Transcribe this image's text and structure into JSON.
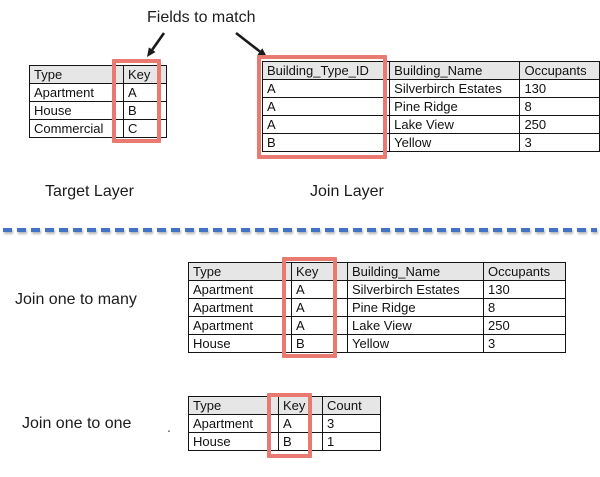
{
  "colors": {
    "highlight_red": "#e87a72",
    "header_gray": "#e7e6e6",
    "divider_blue": "#4472c4",
    "arrow_black": "#1a1a1a"
  },
  "top_section": {
    "annotation": "Fields to match",
    "target_label": "Target Layer",
    "join_label": "Join Layer",
    "target_table": {
      "headers": [
        "Type",
        "Key"
      ],
      "rows": [
        [
          "Apartment",
          "A"
        ],
        [
          "House",
          "B"
        ],
        [
          "Commercial",
          "C"
        ]
      ],
      "highlighted_column": "Key"
    },
    "join_table": {
      "headers": [
        "Building_Type_ID",
        "Building_Name",
        "Occupants"
      ],
      "rows": [
        [
          "A",
          "Silverbirch Estates",
          "130"
        ],
        [
          "A",
          "Pine Ridge",
          "8"
        ],
        [
          "A",
          "Lake View",
          "250"
        ],
        [
          "B",
          "Yellow",
          "3"
        ]
      ],
      "highlighted_column": "Building_Type_ID"
    }
  },
  "bottom_section": {
    "one_to_many_label": "Join one to many",
    "one_to_many_table": {
      "headers": [
        "Type",
        "Key",
        "Building_Name",
        "Occupants"
      ],
      "rows": [
        [
          "Apartment",
          "A",
          "Silverbirch Estates",
          "130"
        ],
        [
          "Apartment",
          "A",
          "Pine Ridge",
          "8"
        ],
        [
          "Apartment",
          "A",
          "Lake View",
          "250"
        ],
        [
          "House",
          "B",
          "Yellow",
          "3"
        ]
      ],
      "highlighted_column": "Key"
    },
    "one_to_one_label": "Join one to one",
    "one_to_one_table": {
      "headers": [
        "Type",
        "Key",
        "Count"
      ],
      "rows": [
        [
          "Apartment",
          "A",
          "3"
        ],
        [
          "House",
          "B",
          "1"
        ]
      ],
      "highlighted_column": "Key"
    },
    "stray_dot": "."
  }
}
